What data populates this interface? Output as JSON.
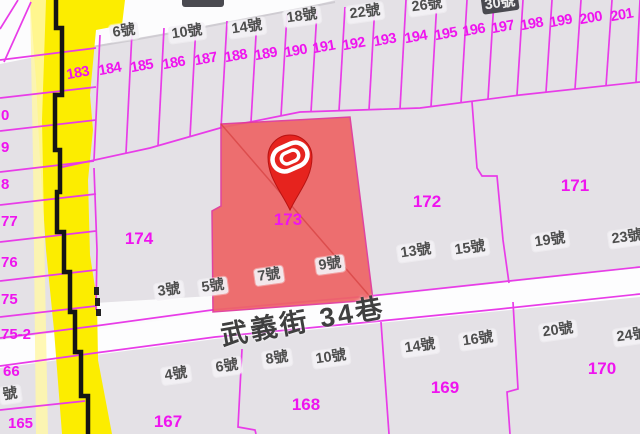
{
  "street": {
    "name": "武義街 34巷"
  },
  "pin": {
    "parcel": "173",
    "icon": "map-pin-with-swirl-logo"
  },
  "colors": {
    "background": "#e4e1e6",
    "parcel_line": "#e83ce8",
    "parcel_number": "#ef14ef",
    "road_highlight_yellow": "#fced00",
    "road_edge_black": "#151515",
    "selected_parcel_fill": "#ee6565",
    "pin_red": "#e6231e",
    "street_white": "#ffffff",
    "house_label_text": "#4e4e4e",
    "house_label_dark_bg": "#4a4a50"
  },
  "labels": {
    "items": [
      {
        "text": "183",
        "x": 78,
        "y": 74,
        "cls": "parcel-sm",
        "rot": -10
      },
      {
        "text": "184",
        "x": 110,
        "y": 70,
        "cls": "parcel-sm",
        "rot": -10
      },
      {
        "text": "185",
        "x": 142,
        "y": 67,
        "cls": "parcel-sm",
        "rot": -10
      },
      {
        "text": "186",
        "x": 174,
        "y": 64,
        "cls": "parcel-sm",
        "rot": -10
      },
      {
        "text": "187",
        "x": 206,
        "y": 60,
        "cls": "parcel-sm",
        "rot": -10
      },
      {
        "text": "188",
        "x": 236,
        "y": 57,
        "cls": "parcel-sm",
        "rot": -10
      },
      {
        "text": "189",
        "x": 266,
        "y": 55,
        "cls": "parcel-sm",
        "rot": -10
      },
      {
        "text": "190",
        "x": 296,
        "y": 52,
        "cls": "parcel-sm",
        "rot": -10
      },
      {
        "text": "191",
        "x": 324,
        "y": 48,
        "cls": "parcel-sm",
        "rot": -10
      },
      {
        "text": "192",
        "x": 354,
        "y": 45,
        "cls": "parcel-sm",
        "rot": -10
      },
      {
        "text": "193",
        "x": 385,
        "y": 41,
        "cls": "parcel-sm",
        "rot": -10
      },
      {
        "text": "194",
        "x": 416,
        "y": 38,
        "cls": "parcel-sm",
        "rot": -10
      },
      {
        "text": "195",
        "x": 446,
        "y": 35,
        "cls": "parcel-sm",
        "rot": -10
      },
      {
        "text": "196",
        "x": 474,
        "y": 31,
        "cls": "parcel-sm",
        "rot": -10
      },
      {
        "text": "197",
        "x": 503,
        "y": 28,
        "cls": "parcel-sm",
        "rot": -10
      },
      {
        "text": "198",
        "x": 532,
        "y": 25,
        "cls": "parcel-sm",
        "rot": -10
      },
      {
        "text": "199",
        "x": 561,
        "y": 22,
        "cls": "parcel-sm",
        "rot": -10
      },
      {
        "text": "200",
        "x": 591,
        "y": 19,
        "cls": "parcel-sm",
        "rot": -10
      },
      {
        "text": "201",
        "x": 622,
        "y": 16,
        "cls": "parcel-sm",
        "rot": -10
      },
      {
        "text": "173",
        "x": 288,
        "y": 220,
        "cls": "parcel-lg",
        "rot": 0
      },
      {
        "text": "174",
        "x": 139,
        "y": 239,
        "cls": "parcel-lg",
        "rot": 0
      },
      {
        "text": "172",
        "x": 427,
        "y": 202,
        "cls": "parcel-lg",
        "rot": 0
      },
      {
        "text": "171",
        "x": 575,
        "y": 186,
        "cls": "parcel-lg",
        "rot": 0
      },
      {
        "text": "170",
        "x": 602,
        "y": 369,
        "cls": "parcel-lg",
        "rot": 0
      },
      {
        "text": "169",
        "x": 445,
        "y": 388,
        "cls": "parcel-lg",
        "rot": 0
      },
      {
        "text": "168",
        "x": 306,
        "y": 405,
        "cls": "parcel-lg",
        "rot": 0
      },
      {
        "text": "167",
        "x": 168,
        "y": 422,
        "cls": "parcel-lg",
        "rot": 0
      },
      {
        "text": "0",
        "x": 1,
        "y": 116,
        "cls": "parcel-cut",
        "rot": 0,
        "align": "left"
      },
      {
        "text": "9",
        "x": 1,
        "y": 148,
        "cls": "parcel-cut",
        "rot": 0,
        "align": "left"
      },
      {
        "text": "8",
        "x": 1,
        "y": 185,
        "cls": "parcel-cut",
        "rot": 0,
        "align": "left"
      },
      {
        "text": "77",
        "x": 1,
        "y": 222,
        "cls": "parcel-cut",
        "rot": 0,
        "align": "left"
      },
      {
        "text": "76",
        "x": 1,
        "y": 263,
        "cls": "parcel-cut",
        "rot": 0,
        "align": "left"
      },
      {
        "text": "75",
        "x": 1,
        "y": 300,
        "cls": "parcel-cut",
        "rot": 0,
        "align": "left"
      },
      {
        "text": "75-2",
        "x": 1,
        "y": 335,
        "cls": "parcel-cut",
        "rot": 0,
        "align": "left"
      },
      {
        "text": "66",
        "x": 3,
        "y": 372,
        "cls": "parcel-cut",
        "rot": 0,
        "align": "left"
      },
      {
        "text": "165",
        "x": 8,
        "y": 424,
        "cls": "parcel-cut",
        "rot": 0,
        "align": "left"
      },
      {
        "text": "6號",
        "x": 124,
        "y": 32,
        "cls": "house",
        "rot": -8
      },
      {
        "text": "10號",
        "x": 187,
        "y": 33,
        "cls": "house",
        "rot": -8
      },
      {
        "text": "14號",
        "x": 247,
        "y": 28,
        "cls": "house",
        "rot": -8
      },
      {
        "text": "18號",
        "x": 302,
        "y": 17,
        "cls": "house",
        "rot": -8
      },
      {
        "text": "22號",
        "x": 365,
        "y": 13,
        "cls": "house",
        "rot": -8
      },
      {
        "text": "26號",
        "x": 427,
        "y": 6,
        "cls": "house",
        "rot": -8
      },
      {
        "text": "30號",
        "x": 500,
        "y": 4,
        "cls": "house-dark",
        "rot": -8
      },
      {
        "text": "13號",
        "x": 416,
        "y": 252,
        "cls": "house",
        "rot": -8
      },
      {
        "text": "15號",
        "x": 470,
        "y": 249,
        "cls": "house",
        "rot": -8
      },
      {
        "text": "19號",
        "x": 550,
        "y": 241,
        "cls": "house",
        "rot": -8
      },
      {
        "text": "23號",
        "x": 627,
        "y": 238,
        "cls": "house",
        "rot": -8
      },
      {
        "text": "3號",
        "x": 169,
        "y": 291,
        "cls": "house",
        "rot": -8
      },
      {
        "text": "5號",
        "x": 213,
        "y": 287,
        "cls": "house",
        "rot": -8
      },
      {
        "text": "7號",
        "x": 269,
        "y": 276,
        "cls": "house",
        "rot": -8
      },
      {
        "text": "9號",
        "x": 330,
        "y": 265,
        "cls": "house",
        "rot": -8
      },
      {
        "text": "4號",
        "x": 176,
        "y": 375,
        "cls": "house",
        "rot": -8
      },
      {
        "text": "6號",
        "x": 227,
        "y": 367,
        "cls": "house",
        "rot": -8
      },
      {
        "text": "8號",
        "x": 277,
        "y": 359,
        "cls": "house",
        "rot": -8
      },
      {
        "text": "10號",
        "x": 331,
        "y": 358,
        "cls": "house",
        "rot": -8
      },
      {
        "text": "14號",
        "x": 420,
        "y": 347,
        "cls": "house",
        "rot": -8
      },
      {
        "text": "16號",
        "x": 478,
        "y": 340,
        "cls": "house",
        "rot": -8
      },
      {
        "text": "20號",
        "x": 558,
        "y": 331,
        "cls": "house",
        "rot": -8
      },
      {
        "text": "24號",
        "x": 632,
        "y": 336,
        "cls": "house",
        "rot": -8
      },
      {
        "text": "號",
        "x": 0,
        "y": 395,
        "cls": "house-cut",
        "rot": -8,
        "align": "left"
      },
      {
        "text": "武義街 34巷",
        "x": 303,
        "y": 322,
        "cls": "street",
        "rot": -10
      }
    ]
  }
}
